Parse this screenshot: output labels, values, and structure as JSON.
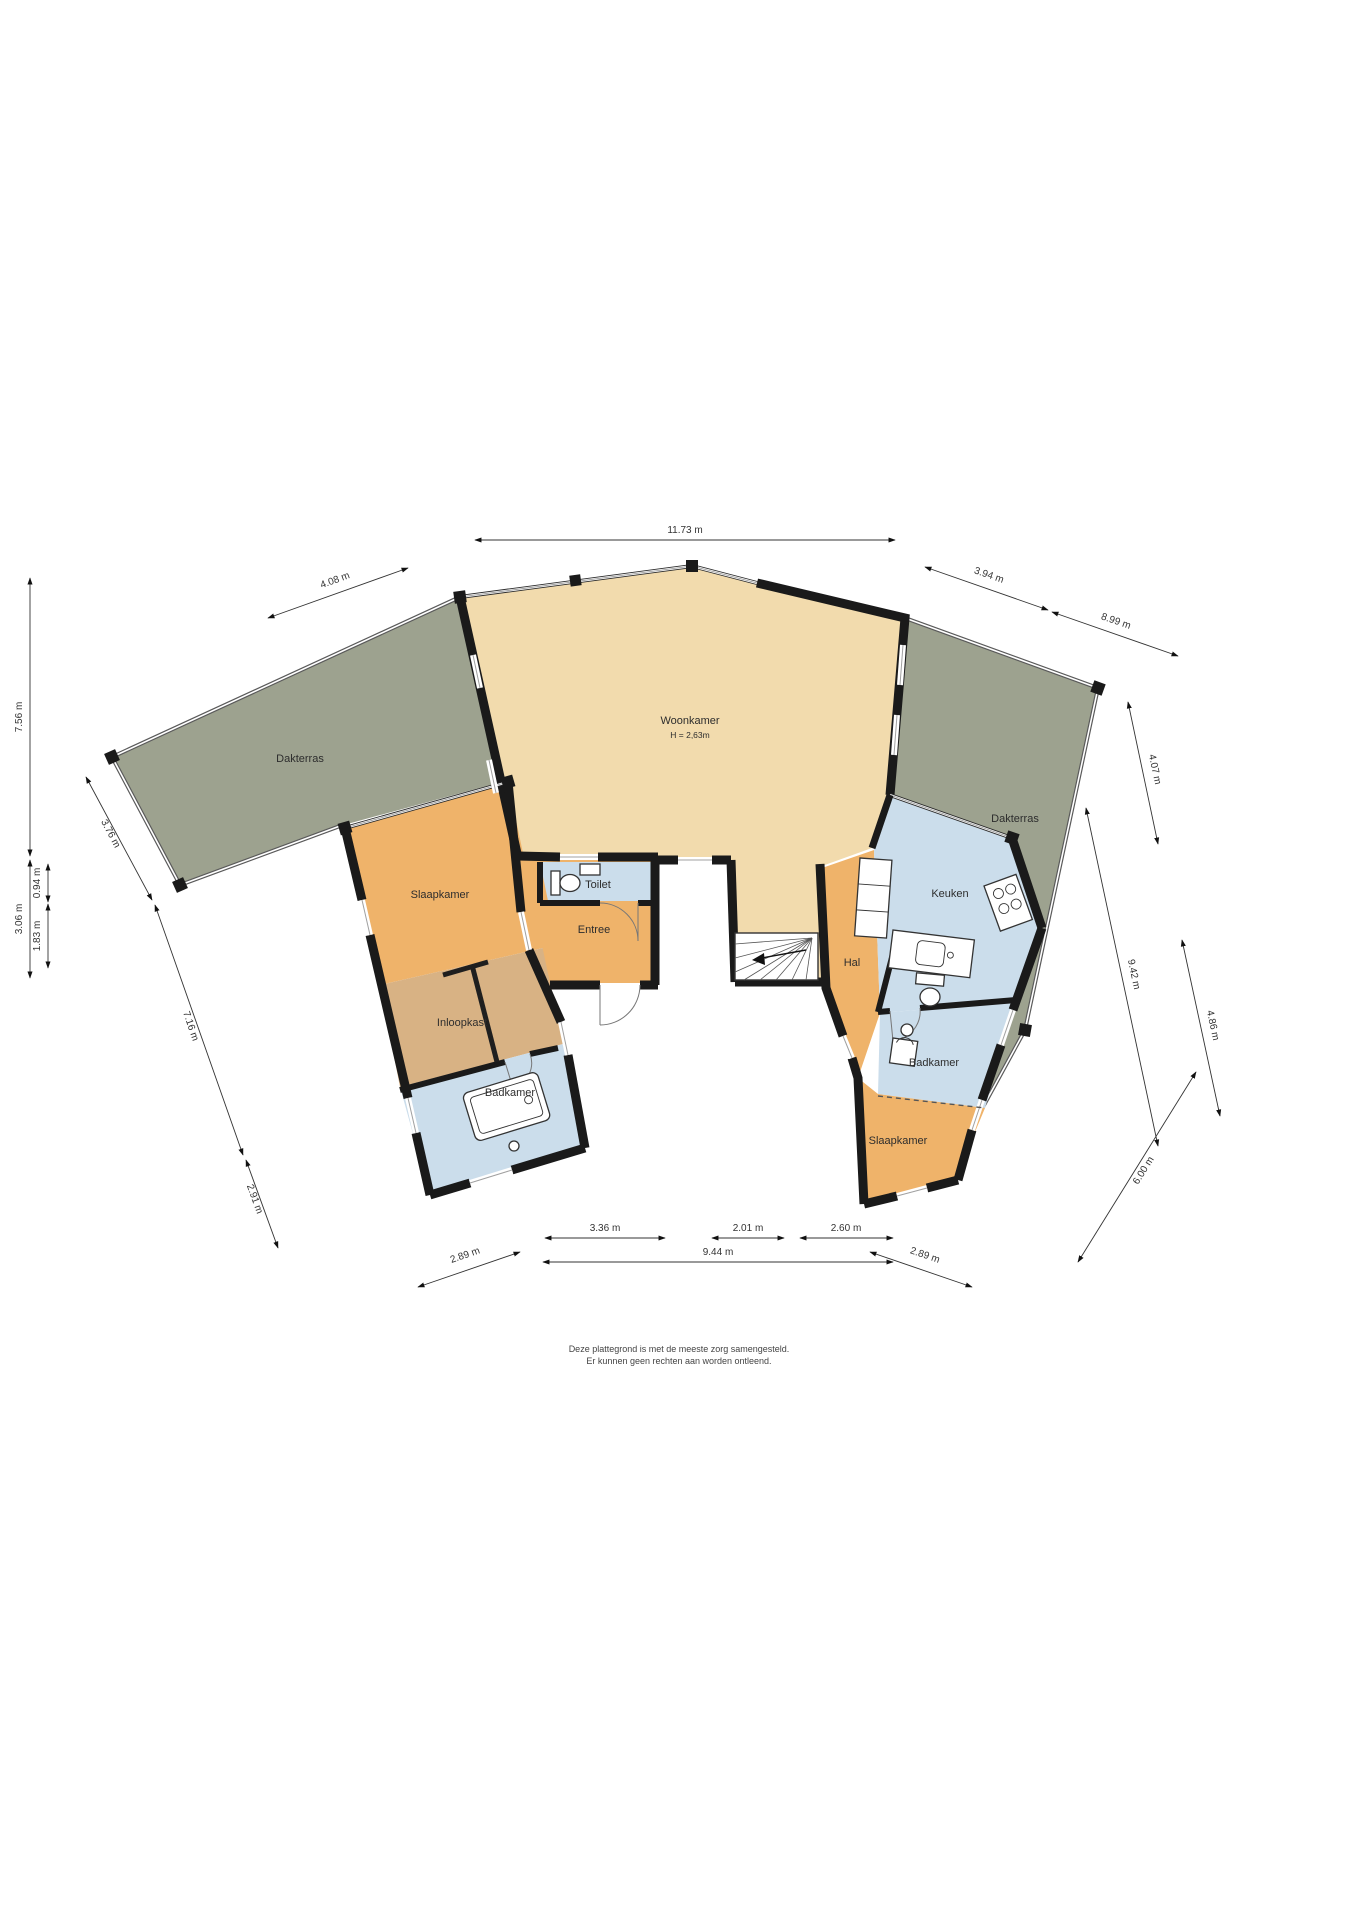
{
  "floorplan": {
    "rooms": {
      "woonkamer": {
        "label": "Woonkamer",
        "height": "H = 2,63m"
      },
      "dakterras_left": {
        "label": "Dakterras"
      },
      "dakterras_right": {
        "label": "Dakterras"
      },
      "slaapkamer_left": {
        "label": "Slaapkamer"
      },
      "inloopkast": {
        "label": "Inloopkast"
      },
      "badkamer_left": {
        "label": "Badkamer"
      },
      "toilet": {
        "label": "Toilet"
      },
      "entree": {
        "label": "Entree"
      },
      "hal": {
        "label": "Hal"
      },
      "keuken": {
        "label": "Keuken"
      },
      "badkamer_right": {
        "label": "Badkamer"
      },
      "slaapkamer_right": {
        "label": "Slaapkamer"
      }
    },
    "dimensions": {
      "top_width": "11.73 m",
      "terrace_left_top": "4.08 m",
      "terrace_right_upper": "3.94 m",
      "terrace_right_outer": "8.99 m",
      "left_upper": "7.56 m",
      "left_lower": "3.06 m",
      "left_inner_upper": "0.94 m",
      "left_inner_lower": "1.83 m",
      "left_diag_upper": "3.76 m",
      "left_diag_middle": "7.16 m",
      "left_diag_lower": "2.91 m",
      "bottom_left": "3.36 m",
      "bottom_middle": "2.01 m",
      "bottom_right": "2.60 m",
      "bottom_total": "9.44 m",
      "bottom_diag_left": "2.89 m",
      "bottom_diag_right": "2.89 m",
      "right_top": "4.07 m",
      "right_middle_long": "9.42 m",
      "right_middle_short": "4.86 m",
      "right_bottom": "6.00 m"
    },
    "disclaimer": {
      "line1": "Deze plattegrond is met de meeste zorg samengesteld.",
      "line2": "Er kunnen geen rechten aan worden ontleend."
    },
    "colors": {
      "floor_beige": "#F2DBAD",
      "floor_orange": "#EFB36A",
      "floor_tan": "#D8B284",
      "floor_blue": "#CBDDEB",
      "terrace_green": "#9DA28F",
      "wall_black": "#1A1A1A"
    }
  }
}
